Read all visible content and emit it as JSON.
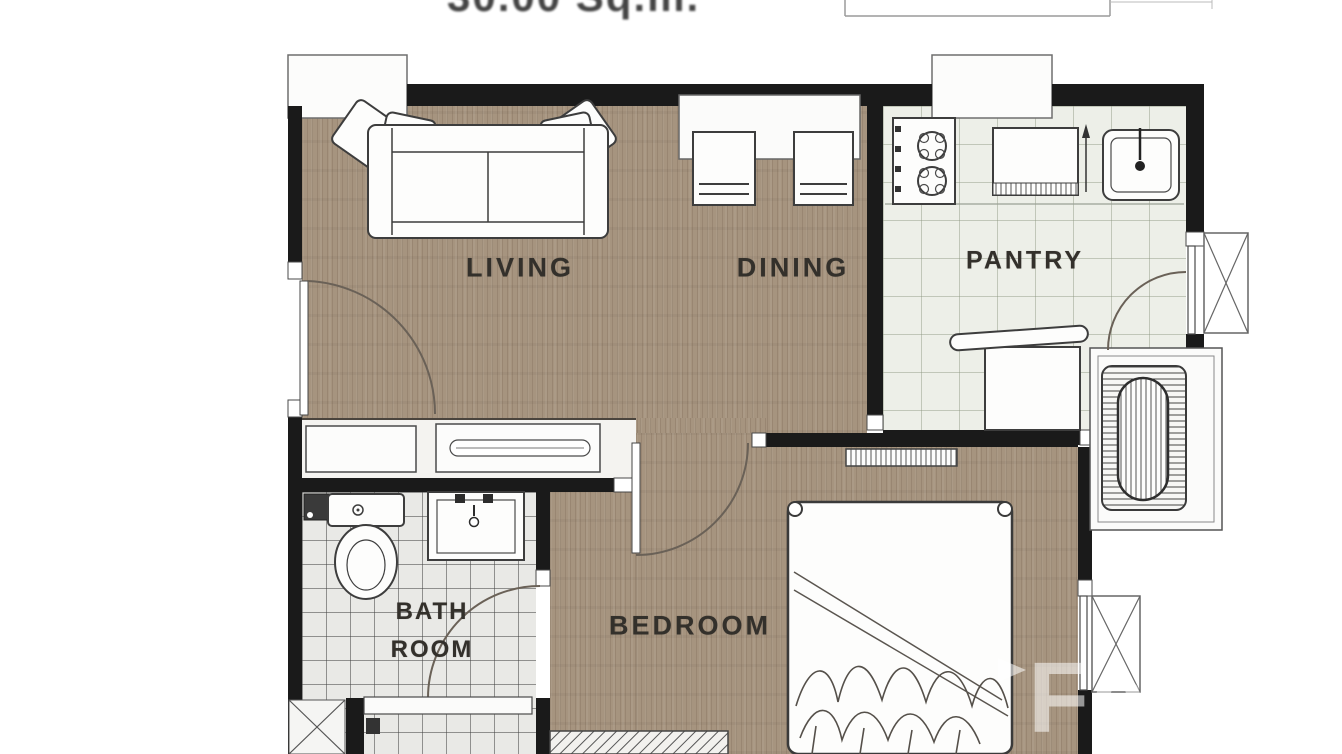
{
  "header": {
    "area_caption_fragment": "30.00 Sq.m.",
    "title_block_present": true
  },
  "rooms": {
    "living": {
      "label": "LIVING"
    },
    "dining": {
      "label": "DINING"
    },
    "pantry": {
      "label": "PANTRY"
    },
    "bathroom": {
      "label_line1": "BATH",
      "label_line2": "ROOM"
    },
    "bedroom": {
      "label": "BEDROOM"
    }
  },
  "furniture": {
    "living": [
      "sofa-with-pillows"
    ],
    "dining": [
      "dining-table",
      "dining-chair",
      "dining-chair"
    ],
    "pantry": [
      "two-burner-stove",
      "counter-appliance",
      "kitchen-sink",
      "lower-counter"
    ],
    "bathroom": [
      "toilet",
      "wash-basin",
      "shower-enclosure",
      "floor-drain"
    ],
    "bedroom": [
      "double-bed",
      "headboard-shelf",
      "foot-cabinet"
    ],
    "balcony": [
      "condenser-unit",
      "louvre-window",
      "louvre-window"
    ]
  },
  "doors": [
    "entrance-door",
    "bedroom-door",
    "bathroom-door",
    "balcony-door"
  ],
  "watermark": {
    "letters": "Fa",
    "icon": "play-triangle"
  },
  "palette": {
    "wall": "#1a1a1a",
    "wood_floor": "#a6947f",
    "bath_tile": "#e9e9e6",
    "pantry_tile": "#edefe8",
    "furniture_outline": "#3d3d3d",
    "door_arc": "#6a6157",
    "label_text": "#33302b"
  }
}
